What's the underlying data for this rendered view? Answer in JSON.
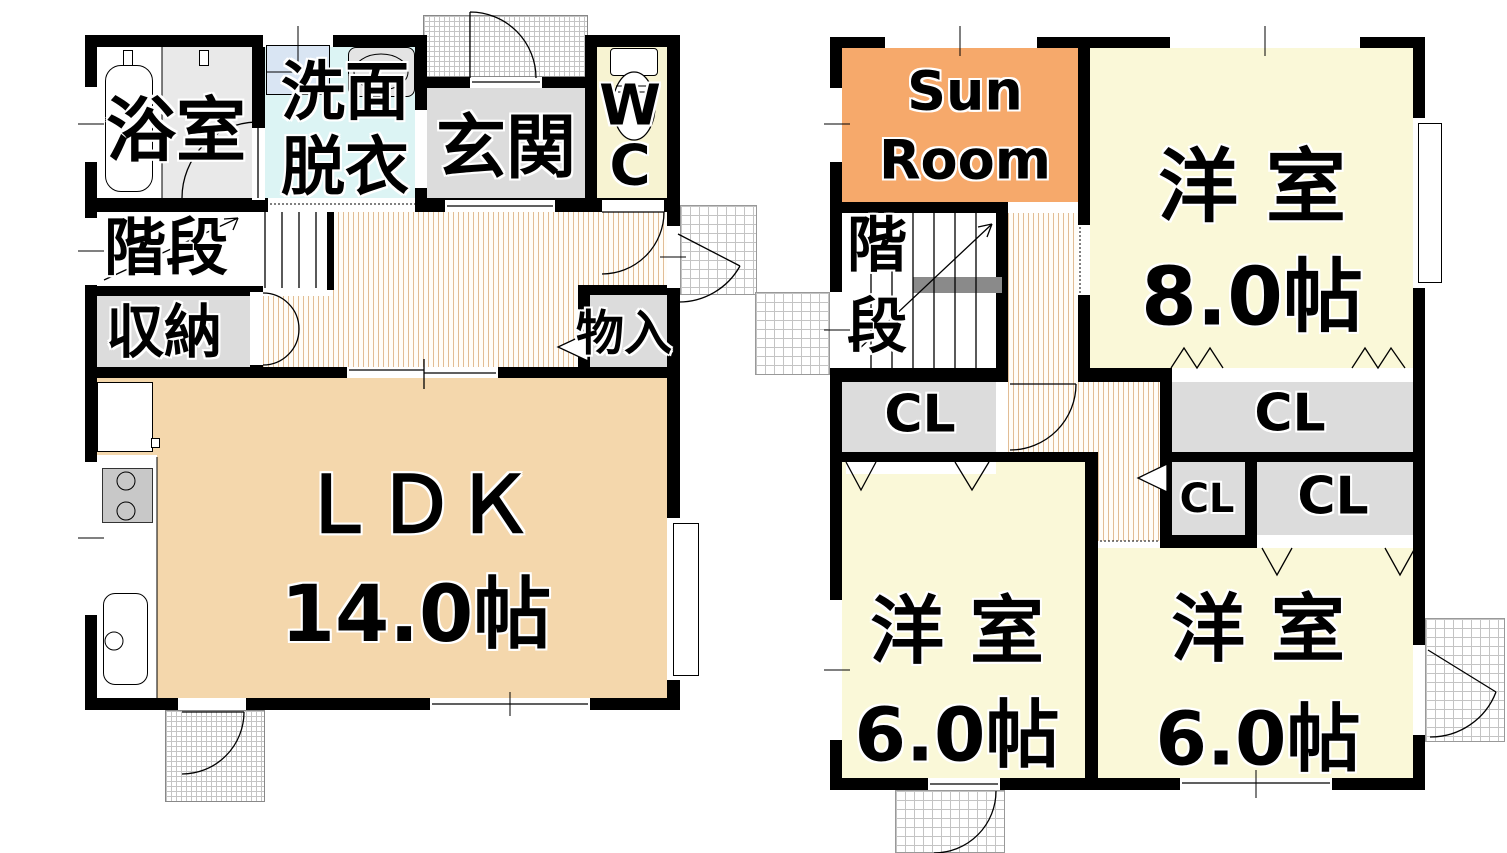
{
  "floor1": {
    "bathroom": "浴室",
    "washroom": "洗面\n脱衣",
    "entrance": "玄関",
    "toilet": "W\nC",
    "stairs": "階段",
    "storage": "収納",
    "closet": "物入",
    "ldk": "ＬＤＫ\n14.0帖"
  },
  "floor2": {
    "sunroom": "Sun\nRoom",
    "stairs": "階\n段",
    "western_room_8": "洋 室\n8.0帖",
    "closet_under_stairs": "CL",
    "closet_large": "CL",
    "closet_small_left": "CL",
    "closet_small_right": "CL",
    "western_room_6_left": "洋 室\n6.0帖",
    "western_room_6_right": "洋 室\n6.0帖"
  },
  "colors": {
    "wall": "#000000",
    "ldk_floor": "#f4d7ac",
    "western_room_floor": "#faf8d8",
    "sunroom_floor": "#f6a96b",
    "wc_floor": "#f7f3d2",
    "washroom_floor": "#dcf4f4",
    "gray_floor": "#dcdcdc",
    "bathroom_gray": "#e9e9e9",
    "corridor_stripe": "#e2bd95",
    "handrail": "#8a8a8a",
    "washing_machine": "#d9e5f3",
    "stove": "#c8c8c8",
    "grid_line": "#c4c4c4"
  }
}
